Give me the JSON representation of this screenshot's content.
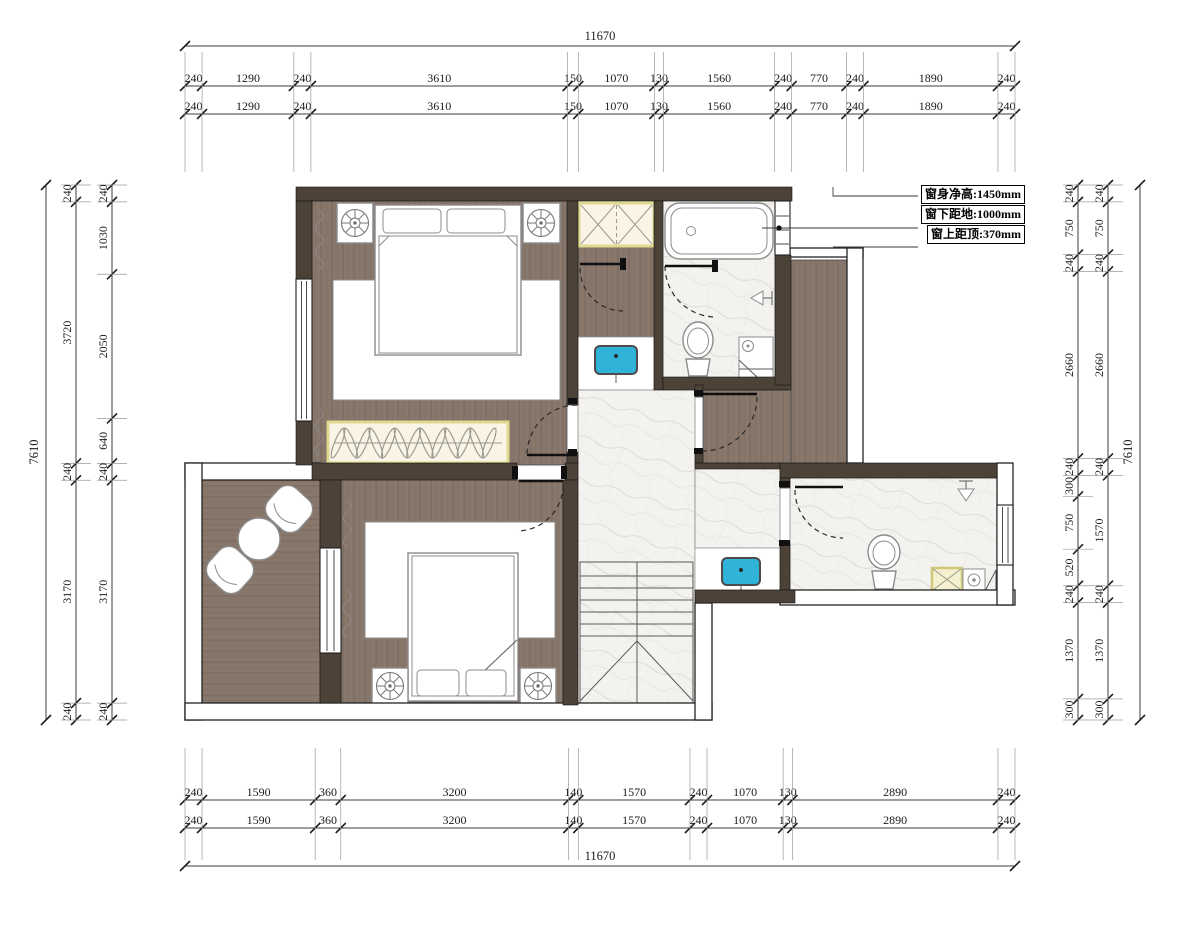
{
  "annotation": {
    "rows": [
      {
        "label": "窗身净高:",
        "value": "1450mm"
      },
      {
        "label": "窗下距地:",
        "value": "1000mm"
      },
      {
        "label": "窗上距顶:",
        "value": "370mm"
      }
    ]
  },
  "dimensions": {
    "top": {
      "total": "11670",
      "rows": [
        [
          240,
          1290,
          240,
          3610,
          150,
          1070,
          130,
          1560,
          240,
          770,
          240,
          1890,
          240
        ],
        [
          240,
          1290,
          240,
          3610,
          150,
          1070,
          130,
          1560,
          240,
          770,
          240,
          1890,
          240
        ]
      ]
    },
    "bottom": {
      "total": "11670",
      "rows": [
        [
          240,
          1590,
          360,
          3200,
          140,
          1570,
          240,
          1070,
          130,
          2890,
          240
        ],
        [
          240,
          1590,
          360,
          3200,
          140,
          1570,
          240,
          1070,
          130,
          2890,
          240
        ]
      ]
    },
    "left": {
      "total": "7610",
      "columns": [
        {
          "name": "outer",
          "values": [
            240,
            3720,
            240,
            3170,
            240
          ]
        },
        {
          "name": "inner",
          "values": [
            240,
            1030,
            2050,
            640,
            240,
            3170,
            240
          ]
        }
      ]
    },
    "right": {
      "total": "7610",
      "columns": [
        {
          "name": "inner",
          "values": [
            240,
            750,
            240,
            2660,
            240,
            300,
            750,
            520,
            240,
            1370,
            300
          ]
        },
        {
          "name": "outer",
          "values": [
            240,
            750,
            240,
            2660,
            240,
            1570,
            240,
            1370,
            300
          ]
        }
      ]
    }
  },
  "colors": {
    "wall": "#4c4238",
    "wood": "#87766a",
    "marble": "#f3f2ef",
    "sink_cyan": "#2fb3d9",
    "cabinet_yellow": "#ded98f",
    "cabinet_cream": "#faf4e6"
  },
  "icons": [
    "bed-icon",
    "pillow-icon",
    "nightstand-lamp-icon",
    "wardrobe-hangers-icon",
    "bathtub-icon",
    "toilet-icon",
    "shower-head-icon",
    "washing-machine-icon",
    "sink-icon",
    "stairs-icon",
    "door-swing-icon",
    "window-icon",
    "curtain-icon",
    "armchair-icon",
    "round-table-icon",
    "storage-x-cabinet-icon"
  ]
}
